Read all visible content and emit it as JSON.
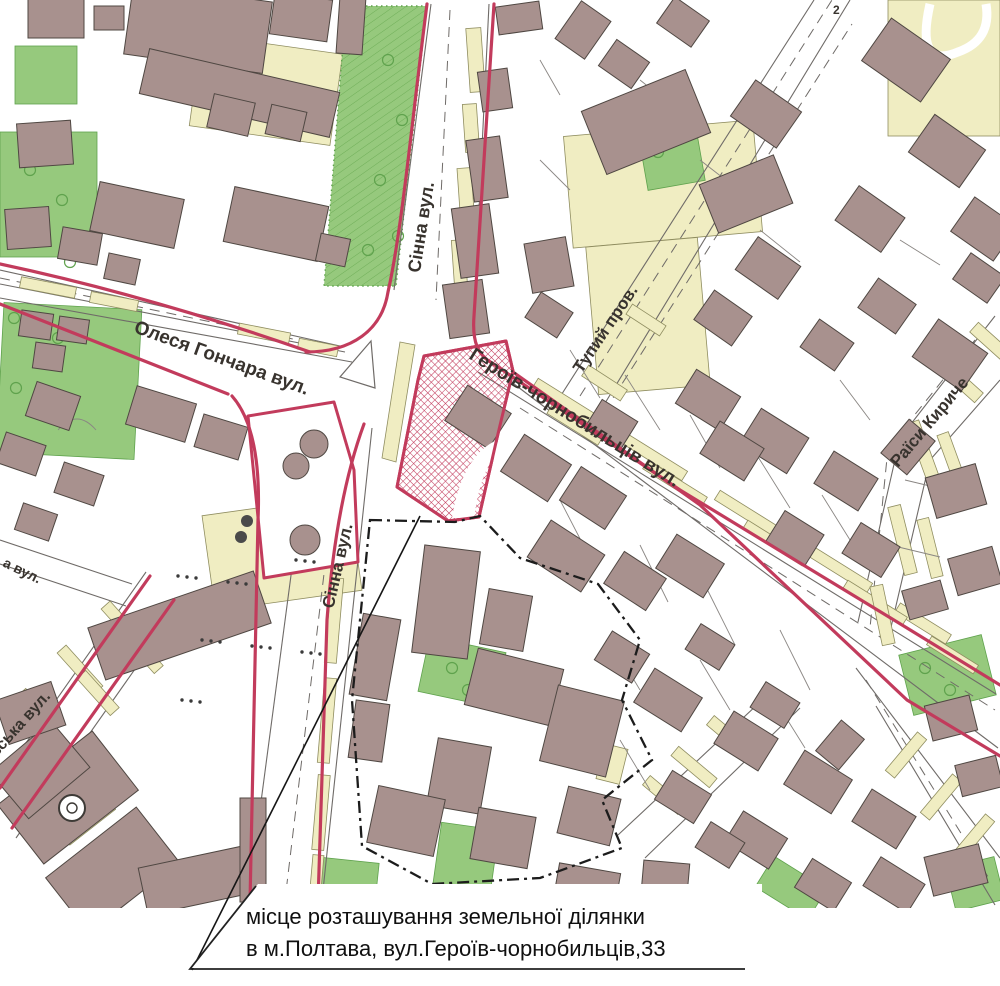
{
  "map": {
    "labels": {
      "sinna_top": "Сінна вул.",
      "olesya_honchara": "Олеся Гончара вул.",
      "heroiv_chornobyltsiv": "Героїв-чорнобильців вул.",
      "tupyi_prov": "Тупий пров.",
      "raisy_kyrychenko": "Раїси Кириче",
      "sinna_bottom": "Сінна вул.",
      "vska_vul": "вська вул.",
      "a_vul": "а вул.",
      "corner_mark": "2"
    },
    "caption": {
      "line1": "місце розташування земельної ділянки",
      "line2": "в м.Полтава, вул.Героїв-чорнобильців,33"
    },
    "colors": {
      "building": "#a8918e",
      "building_outline": "#4f4742",
      "green": "#96c97d",
      "green_dark": "#5fa24d",
      "cream": "#f0edc2",
      "cream_outline": "#8f8d60",
      "parcel_red": "#c23b5c",
      "road_line": "#6f6b68",
      "boundary_black": "#1c1c1c",
      "label_ink": "#38332e",
      "paper": "#ffffff"
    }
  }
}
